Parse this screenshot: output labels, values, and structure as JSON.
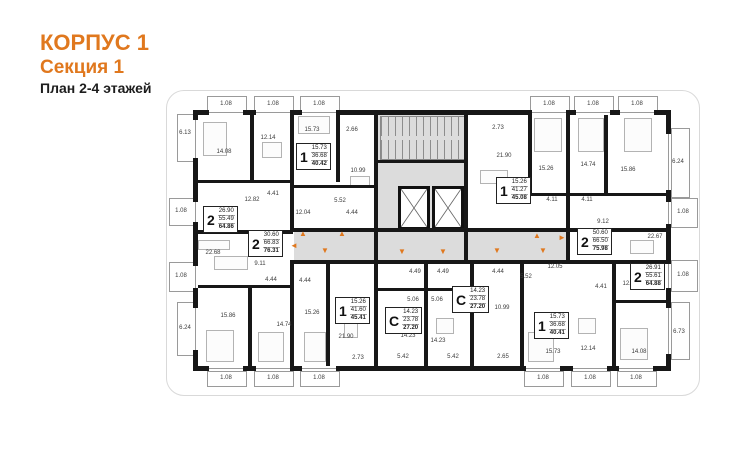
{
  "title": {
    "building": "КОРПУС 1",
    "section": "Секция 1",
    "plan": "План 2-4 этажей"
  },
  "colors": {
    "accent": "#E0781E",
    "wall": "#171717",
    "corridor": "#dcdcdc"
  },
  "units": [
    {
      "type": "1",
      "areas": [
        "15.73",
        "36.68",
        "40.42"
      ],
      "x": 296,
      "y": 143
    },
    {
      "type": "2",
      "areas": [
        "26.90",
        "55.49",
        "64.86"
      ],
      "x": 203,
      "y": 206
    },
    {
      "type": "2",
      "areas": [
        "30.60",
        "66.83",
        "76.31"
      ],
      "x": 248,
      "y": 230
    },
    {
      "type": "1",
      "areas": [
        "15.26",
        "41.27",
        "45.08"
      ],
      "x": 496,
      "y": 177
    },
    {
      "type": "2",
      "areas": [
        "50.60",
        "66.50",
        "75.98"
      ],
      "x": 577,
      "y": 228
    },
    {
      "type": "2",
      "areas": [
        "26.91",
        "55.61",
        "64.88"
      ],
      "x": 630,
      "y": 263
    },
    {
      "type": "1",
      "areas": [
        "15.26",
        "41.60",
        "45.41"
      ],
      "x": 335,
      "y": 297
    },
    {
      "type": "С",
      "areas": [
        "14.23",
        "23.78",
        "27.20"
      ],
      "x": 385,
      "y": 307
    },
    {
      "type": "С",
      "areas": [
        "14.23",
        "23.78",
        "27.20"
      ],
      "x": 452,
      "y": 286
    },
    {
      "type": "1",
      "areas": [
        "15.73",
        "36.68",
        "40.41"
      ],
      "x": 534,
      "y": 312
    }
  ],
  "rooms": [
    {
      "t": "6.13",
      "x": 185,
      "y": 133
    },
    {
      "t": "14.08",
      "x": 224,
      "y": 152
    },
    {
      "t": "12.14",
      "x": 268,
      "y": 138
    },
    {
      "t": "15.73",
      "x": 312,
      "y": 130
    },
    {
      "t": "2.66",
      "x": 352,
      "y": 130
    },
    {
      "t": "10.99",
      "x": 358,
      "y": 171
    },
    {
      "t": "12.82",
      "x": 252,
      "y": 200
    },
    {
      "t": "4.41",
      "x": 273,
      "y": 194
    },
    {
      "t": "12.04",
      "x": 303,
      "y": 213
    },
    {
      "t": "5.52",
      "x": 340,
      "y": 201
    },
    {
      "t": "4.44",
      "x": 352,
      "y": 213
    },
    {
      "t": "1.08",
      "x": 181,
      "y": 211
    },
    {
      "t": "22.68",
      "x": 213,
      "y": 253
    },
    {
      "t": "9.11",
      "x": 260,
      "y": 264
    },
    {
      "t": "4.44",
      "x": 271,
      "y": 280
    },
    {
      "t": "4.44",
      "x": 305,
      "y": 281
    },
    {
      "t": "1.08",
      "x": 181,
      "y": 276
    },
    {
      "t": "15.86",
      "x": 228,
      "y": 316
    },
    {
      "t": "14.74",
      "x": 284,
      "y": 325
    },
    {
      "t": "15.26",
      "x": 312,
      "y": 313
    },
    {
      "t": "6.24",
      "x": 185,
      "y": 328
    },
    {
      "t": "21.90",
      "x": 346,
      "y": 337
    },
    {
      "t": "2.73",
      "x": 358,
      "y": 358
    },
    {
      "t": "5.42",
      "x": 403,
      "y": 357
    },
    {
      "t": "5.42",
      "x": 453,
      "y": 357
    },
    {
      "t": "5.06",
      "x": 413,
      "y": 300
    },
    {
      "t": "5.06",
      "x": 437,
      "y": 300
    },
    {
      "t": "14.23",
      "x": 408,
      "y": 336
    },
    {
      "t": "14.23",
      "x": 438,
      "y": 341
    },
    {
      "t": "4.49",
      "x": 415,
      "y": 272
    },
    {
      "t": "4.49",
      "x": 443,
      "y": 272
    },
    {
      "t": "4.44",
      "x": 498,
      "y": 272
    },
    {
      "t": "5.52",
      "x": 526,
      "y": 277
    },
    {
      "t": "12.05",
      "x": 555,
      "y": 267
    },
    {
      "t": "10.99",
      "x": 502,
      "y": 308
    },
    {
      "t": "2.65",
      "x": 503,
      "y": 357
    },
    {
      "t": "15.73",
      "x": 553,
      "y": 352
    },
    {
      "t": "12.14",
      "x": 588,
      "y": 349
    },
    {
      "t": "14.08",
      "x": 639,
      "y": 352
    },
    {
      "t": "6.73",
      "x": 679,
      "y": 332
    },
    {
      "t": "12.83",
      "x": 630,
      "y": 284
    },
    {
      "t": "4.41",
      "x": 601,
      "y": 287
    },
    {
      "t": "22.67",
      "x": 655,
      "y": 237
    },
    {
      "t": "9.12",
      "x": 603,
      "y": 222
    },
    {
      "t": "4.11",
      "x": 552,
      "y": 200
    },
    {
      "t": "4.11",
      "x": 587,
      "y": 200
    },
    {
      "t": "15.26",
      "x": 546,
      "y": 169
    },
    {
      "t": "14.74",
      "x": 588,
      "y": 165
    },
    {
      "t": "15.86",
      "x": 628,
      "y": 170
    },
    {
      "t": "6.24",
      "x": 678,
      "y": 162
    },
    {
      "t": "21.90",
      "x": 504,
      "y": 156
    },
    {
      "t": "2.73",
      "x": 498,
      "y": 128
    },
    {
      "t": "1.08",
      "x": 226,
      "y": 104
    },
    {
      "t": "1.08",
      "x": 273,
      "y": 104
    },
    {
      "t": "1.08",
      "x": 319,
      "y": 104
    },
    {
      "t": "1.08",
      "x": 549,
      "y": 104
    },
    {
      "t": "1.08",
      "x": 593,
      "y": 104
    },
    {
      "t": "1.08",
      "x": 637,
      "y": 104
    },
    {
      "t": "1.08",
      "x": 226,
      "y": 378
    },
    {
      "t": "1.08",
      "x": 273,
      "y": 378
    },
    {
      "t": "1.08",
      "x": 319,
      "y": 378
    },
    {
      "t": "1.08",
      "x": 543,
      "y": 378
    },
    {
      "t": "1.08",
      "x": 590,
      "y": 378
    },
    {
      "t": "1.08",
      "x": 636,
      "y": 378
    },
    {
      "t": "1.08",
      "x": 683,
      "y": 212
    },
    {
      "t": "1.08",
      "x": 683,
      "y": 275
    }
  ],
  "arrows": [
    {
      "d": "up",
      "x": 303,
      "y": 234
    },
    {
      "d": "up",
      "x": 342,
      "y": 234
    },
    {
      "d": "up",
      "x": 537,
      "y": 236
    },
    {
      "d": "down",
      "x": 325,
      "y": 251
    },
    {
      "d": "down",
      "x": 402,
      "y": 252
    },
    {
      "d": "down",
      "x": 443,
      "y": 252
    },
    {
      "d": "down",
      "x": 497,
      "y": 251
    },
    {
      "d": "down",
      "x": 543,
      "y": 251
    },
    {
      "d": "left",
      "x": 294,
      "y": 246
    },
    {
      "d": "right",
      "x": 562,
      "y": 238
    }
  ]
}
